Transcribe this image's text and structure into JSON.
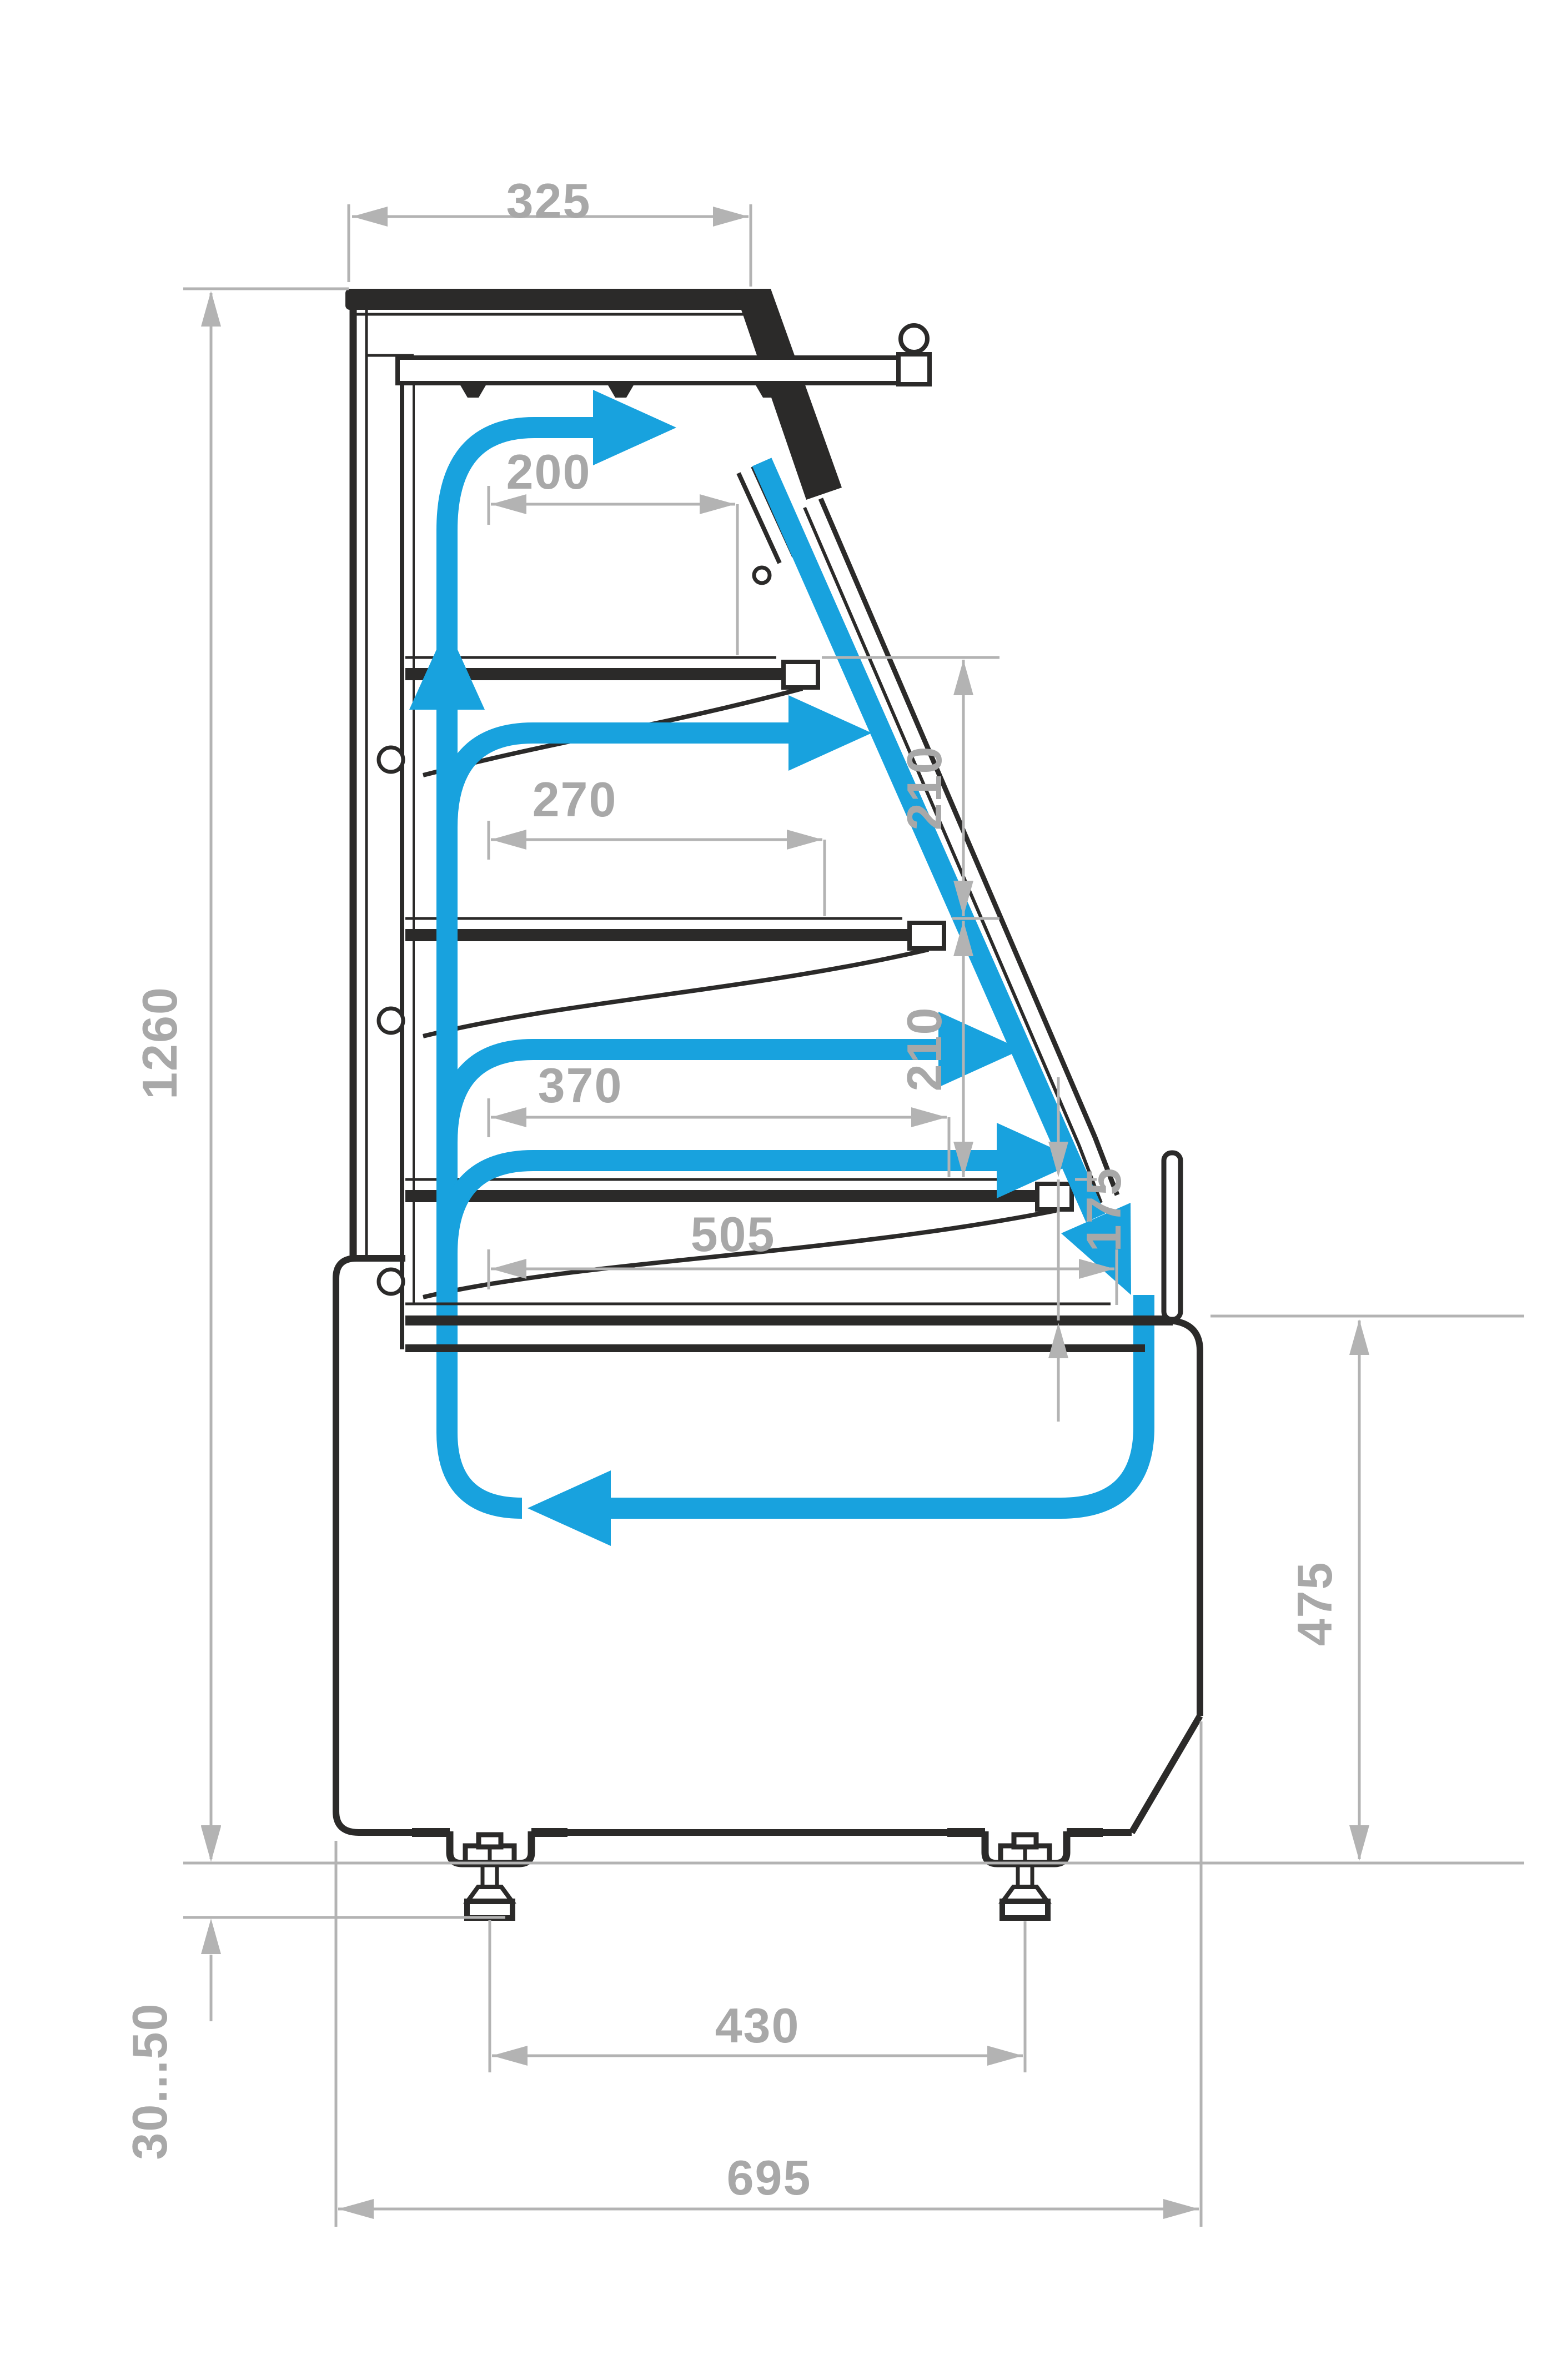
{
  "title": "Refrigerated pastry display case — side cross-section with air circulation",
  "colors": {
    "outline": "#2b2a29",
    "dimension_line": "#b3b3b3",
    "dimension_text": "#a8a8a8",
    "airflow": "#18a2de",
    "background": "#ffffff"
  },
  "labels": {
    "canopy_depth": "325",
    "shelf1_depth": "200",
    "shelf2_depth": "270",
    "shelf3_depth": "370",
    "well_depth": "505",
    "gap_upper": "210",
    "gap_lower": "210",
    "front_glass_height": "175",
    "overall_height": "1260",
    "base_front_height": "475",
    "leg_adjustment": "30...50",
    "leg_spacing": "430",
    "overall_depth": "695"
  }
}
